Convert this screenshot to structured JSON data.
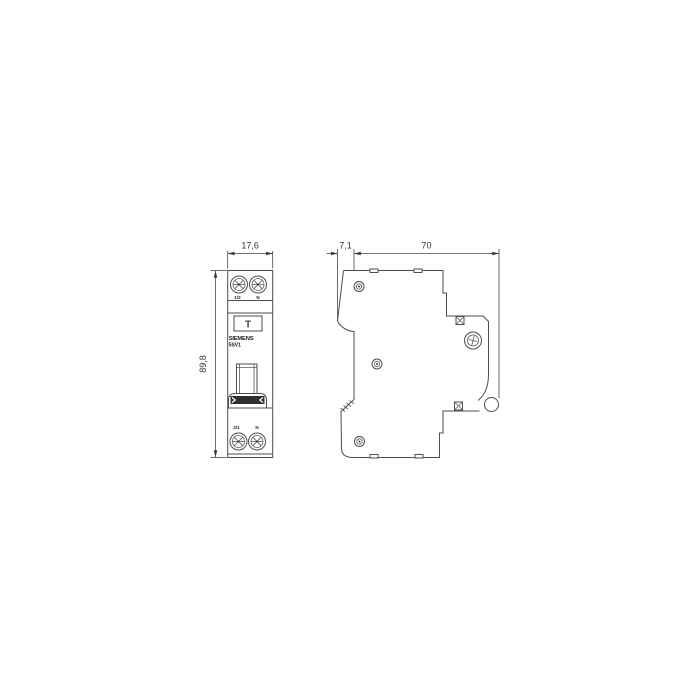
{
  "drawing": {
    "type": "dimension-drawing",
    "views": {
      "left": "front view of 1-module DIN-rail device",
      "right": "side view of 1-module DIN-rail device"
    },
    "front_view": {
      "width_mm": "17,6",
      "height_mm": "89,8",
      "top_terminal_left_label": "1/2",
      "top_terminal_right_label": "N",
      "bottom_terminal_left_label": "2/1",
      "bottom_terminal_right_label": "N",
      "brand_label": "SIEMENS",
      "model_label": "5SV1",
      "test_button_symbol": "T"
    },
    "side_view": {
      "front_depth_mm": "7,1",
      "body_depth_mm": "70"
    },
    "icons": {
      "screw_terminal": "combi-screw-head-circle",
      "rivet": "double-circle-rivet",
      "din_clip": "din-rail-clip-circle",
      "terminal_opening": "hatched-square",
      "vent_slot": "small-rectangle"
    },
    "colors": {
      "background": "#ffffff",
      "line": "#4d4d4d",
      "dimension": "#444444",
      "text": "#333333",
      "toggle_band": "#2e2e2e"
    }
  }
}
